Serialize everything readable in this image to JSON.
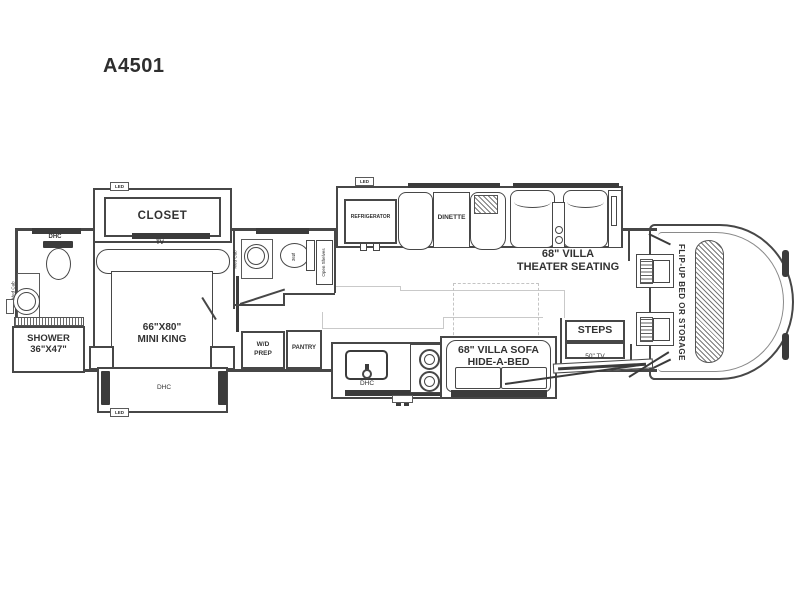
{
  "title": "A4501",
  "colors": {
    "line": "#474747",
    "dark": "#3b3b3b",
    "faint": "#c9c9c9"
  },
  "bedroom": {
    "closet": "CLOSET",
    "closet_led": "LED",
    "tv": "TV",
    "bed_size": "66\"X80\"",
    "bed_type": "MINI KING",
    "slide_dhc": "DHC",
    "slide_led": "LED"
  },
  "bath_rear": {
    "dhc": "DHC",
    "med_cab": "Med Cab",
    "shower_line1": "SHOWER",
    "shower_line2": "36\"X47\""
  },
  "bath_mid": {
    "med_cab": "Med Cab",
    "toilet_dim": "36Ø",
    "open_shelves": "Open Shelves"
  },
  "galley": {
    "wd_line1": "W/D",
    "wd_line2": "PREP",
    "pantry": "PANTRY",
    "fridge": "REFRIGERATOR",
    "fridge_led": "LED",
    "sink_dhc": "DHC"
  },
  "living": {
    "dinette": "DINETTE",
    "theater_line1": "68\" VILLA",
    "theater_line2": "THEATER SEATING",
    "sofa_line1": "68\" VILLA SOFA",
    "sofa_line2": "HIDE-A-BED"
  },
  "entry": {
    "steps": "STEPS",
    "tv": "50\" TV"
  },
  "cockpit": {
    "flip_up_bed": "FLIP-UP BED OR STORAGE"
  }
}
